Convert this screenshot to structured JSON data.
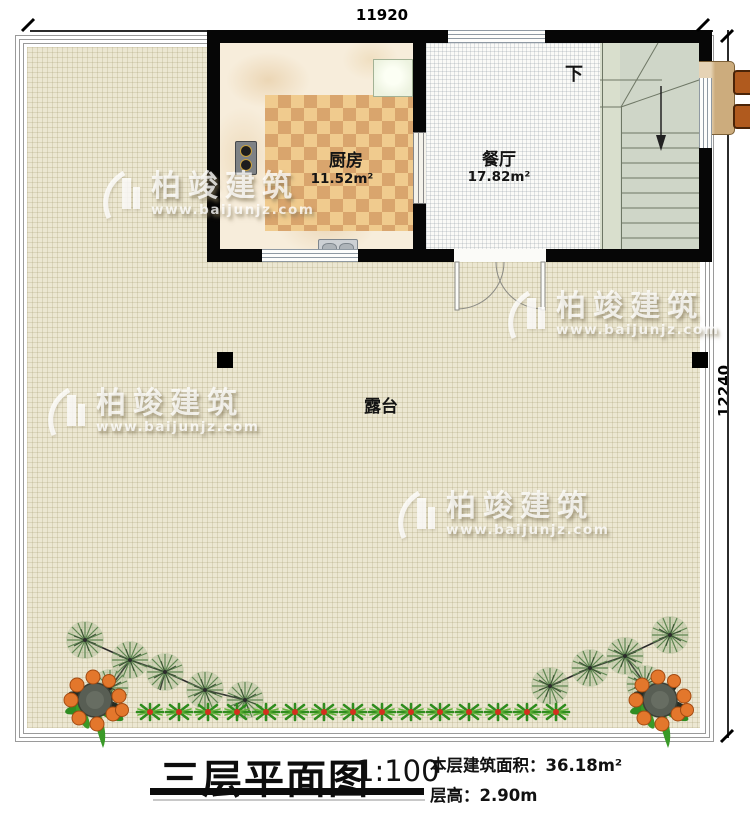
{
  "dimensions": {
    "top": "11920",
    "right": "12240"
  },
  "rooms": {
    "kitchen": {
      "name": "厨房",
      "area": "11.52m²"
    },
    "dining": {
      "name": "餐厅",
      "area": "17.82m²"
    },
    "terrace": {
      "name": "露台"
    },
    "stairs": {
      "down_label": "下"
    }
  },
  "watermark": {
    "brand": "柏竣建筑",
    "url": "www.baijunjz.com"
  },
  "title_block": {
    "title": "三层平面图",
    "scale": "1:100",
    "area_line": "本层建筑面积：36.18m²",
    "height_line": "层高：2.90m"
  },
  "colors": {
    "wall": "#060606",
    "terrace_floor": "#ece7d2",
    "checker_light": "#f0cb8e",
    "checker_dark": "#d9a56d",
    "stair_floor": "#cfd6c8",
    "dining_floor": "#fafaf7",
    "table_wood": "#d9bc8d",
    "chair": "#b05a1e",
    "fruit_orange": "#e3772c",
    "plant_green": "#2f8c1e"
  }
}
